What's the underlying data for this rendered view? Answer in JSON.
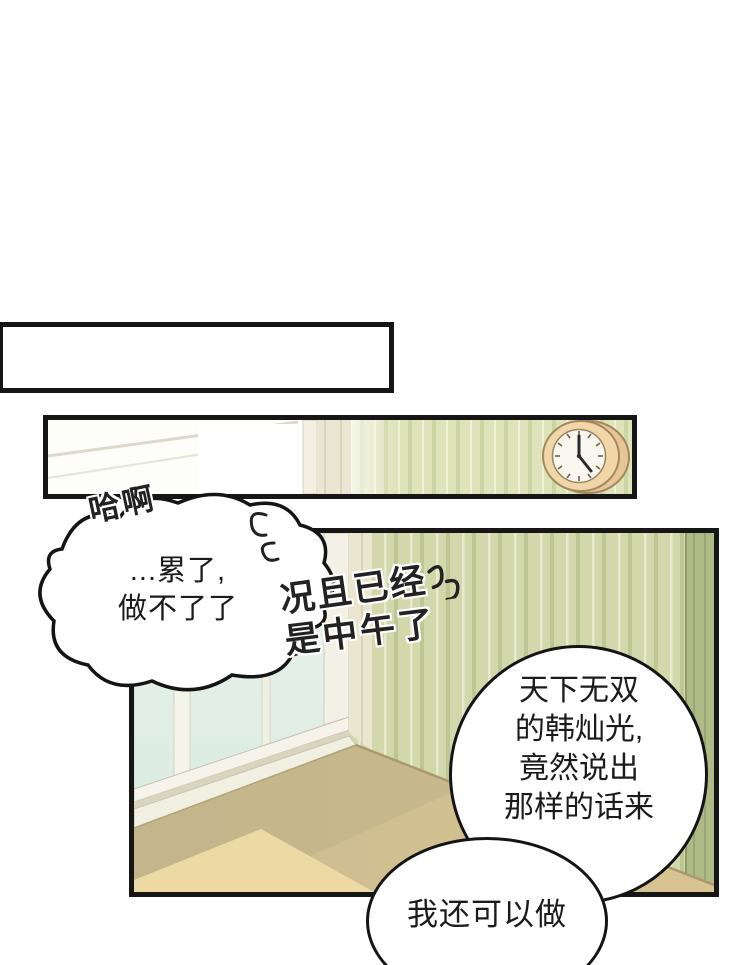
{
  "comic": {
    "sigh": "哈啊",
    "cloud_bubble": {
      "line1": "...累了,",
      "line2": "做不了了"
    },
    "handwritten": {
      "line1": "况且已经",
      "line2": "是中午了"
    },
    "circle_bubble": {
      "line1": "天下无双",
      "line2": "的韩灿光,",
      "line3": "竟然说出",
      "line4": "那样的话来"
    },
    "bottom_bubble": {
      "line1": "我还可以做"
    }
  },
  "scene": {
    "colors": {
      "panel_border": "#161616",
      "bubble_outline": "#141414",
      "wall_green": "#d2d8ab",
      "wall_stripe_dark": "#bdc794",
      "wall_stripe_light": "#e7eacf",
      "wall_corner_dark": "#afba87",
      "window_glass": "#e4f0e7",
      "window_frame": "#f5f4ea",
      "floor_tan": "#d3c08f",
      "floor_bright": "#ecd9a4",
      "floor_shadow": "#bfb28a",
      "clock_body": "#f0d6a8",
      "clock_face": "#f8f6ee"
    }
  }
}
